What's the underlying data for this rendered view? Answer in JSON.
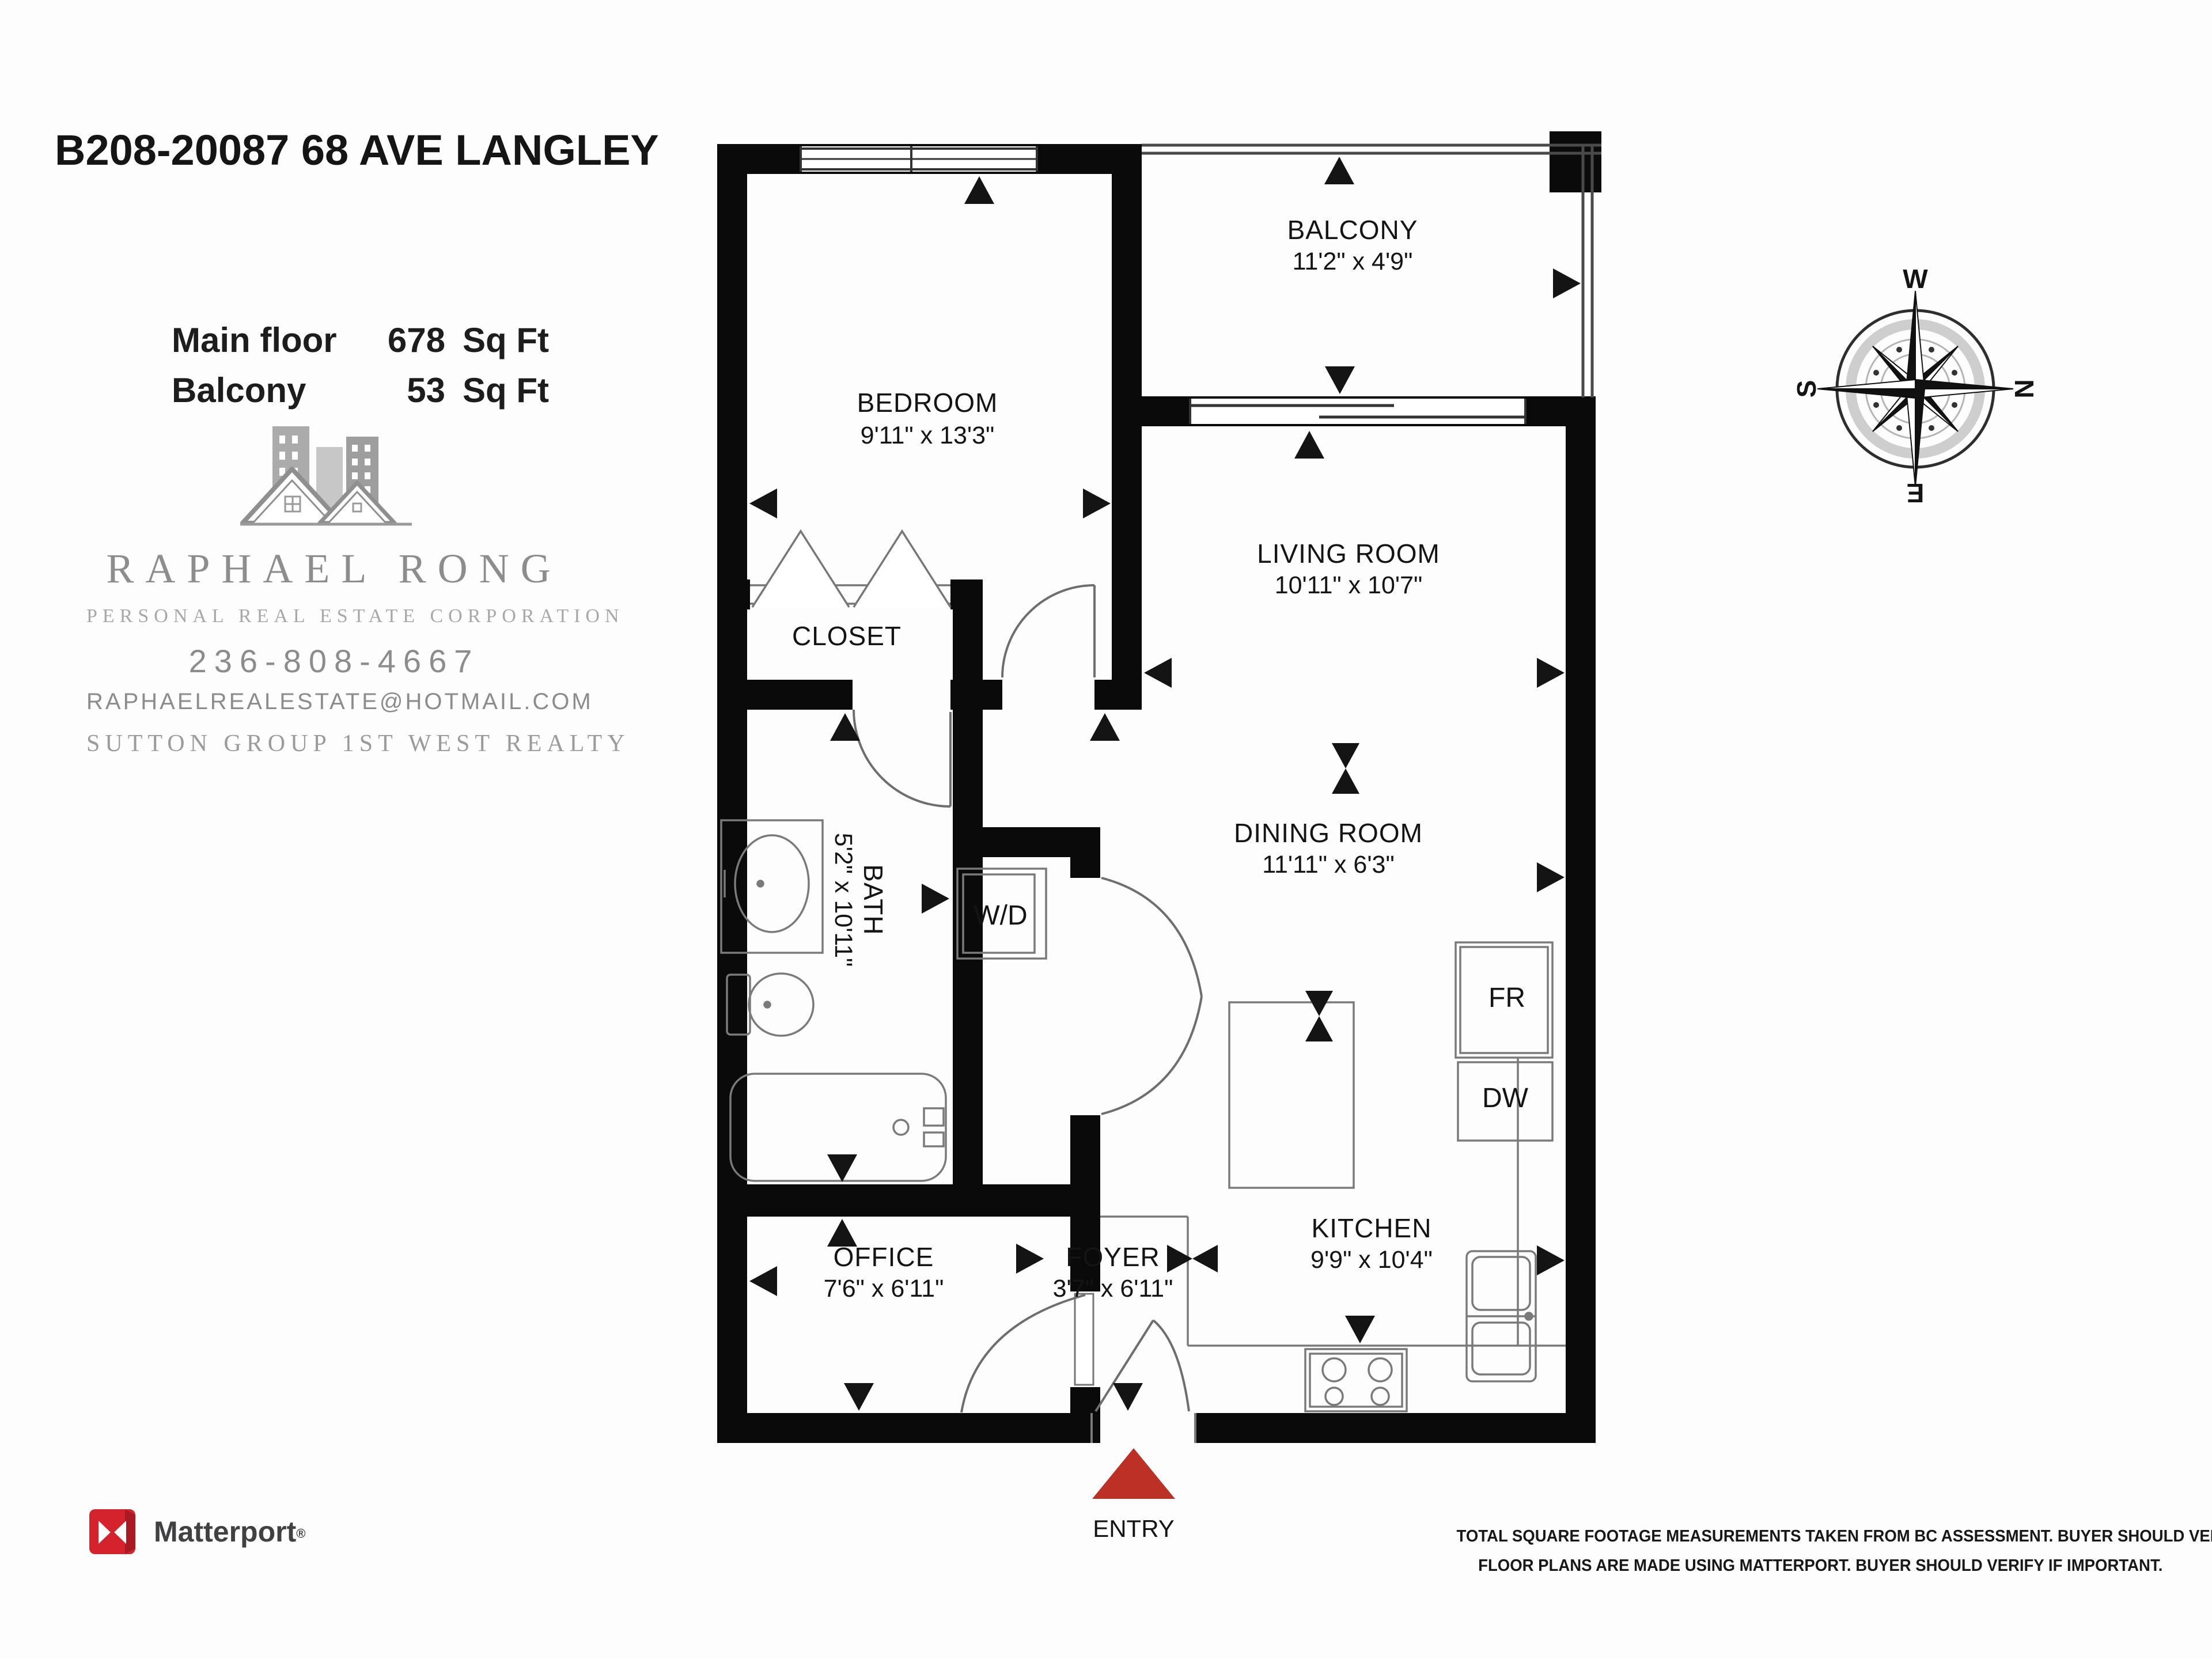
{
  "header": {
    "title": "B208-20087 68 AVE LANGLEY"
  },
  "areas": [
    {
      "label": "Main floor",
      "value": "678",
      "unit": "Sq Ft"
    },
    {
      "label": "Balcony",
      "value": "53",
      "unit": "Sq Ft"
    }
  ],
  "agent": {
    "name": "RAPHAEL RONG",
    "tagline": "PERSONAL REAL ESTATE CORPORATION",
    "phone": "236-808-4667",
    "email": "RAPHAELREALESTATE@HOTMAIL.COM",
    "brokerage": "SUTTON GROUP 1ST WEST REALTY"
  },
  "compass": {
    "top": "W",
    "right": "N",
    "bottom": "E",
    "left": "S"
  },
  "plan": {
    "wall_color": "#0a0a0a",
    "entry_arrow_color": "#bd3026",
    "rooms": [
      {
        "id": "balcony",
        "name": "BALCONY",
        "dims": "11'2\" x 4'9\""
      },
      {
        "id": "bedroom",
        "name": "BEDROOM",
        "dims": "9'11\" x 13'3\""
      },
      {
        "id": "living",
        "name": "LIVING ROOM",
        "dims": "10'11\" x 10'7\""
      },
      {
        "id": "closet",
        "name": "CLOSET",
        "dims": ""
      },
      {
        "id": "bath",
        "name": "BATH",
        "dims": "5'2\" x 10'11\""
      },
      {
        "id": "dining",
        "name": "DINING ROOM",
        "dims": "11'11\" x 6'3\""
      },
      {
        "id": "office",
        "name": "OFFICE",
        "dims": "7'6\" x 6'11\""
      },
      {
        "id": "foyer",
        "name": "FOYER",
        "dims": "3'7\" x 6'11\""
      },
      {
        "id": "kitchen",
        "name": "KITCHEN",
        "dims": "9'9\" x 10'4\""
      }
    ],
    "fixtures": {
      "washer_dryer": "W/D",
      "fridge": "FR",
      "dishwasher": "DW"
    },
    "entry_label": "ENTRY"
  },
  "footer": {
    "matterport_wordmark": "Matterport",
    "registered_mark": "®",
    "matterport_red": "#d5232e",
    "disclaimer_line1": "TOTAL SQUARE FOOTAGE MEASUREMENTS TAKEN FROM BC ASSESSMENT. BUYER SHOULD VERIFY IF IMPORTANT.",
    "disclaimer_line2": "FLOOR PLANS ARE MADE USING MATTERPORT. BUYER SHOULD VERIFY IF IMPORTANT."
  }
}
